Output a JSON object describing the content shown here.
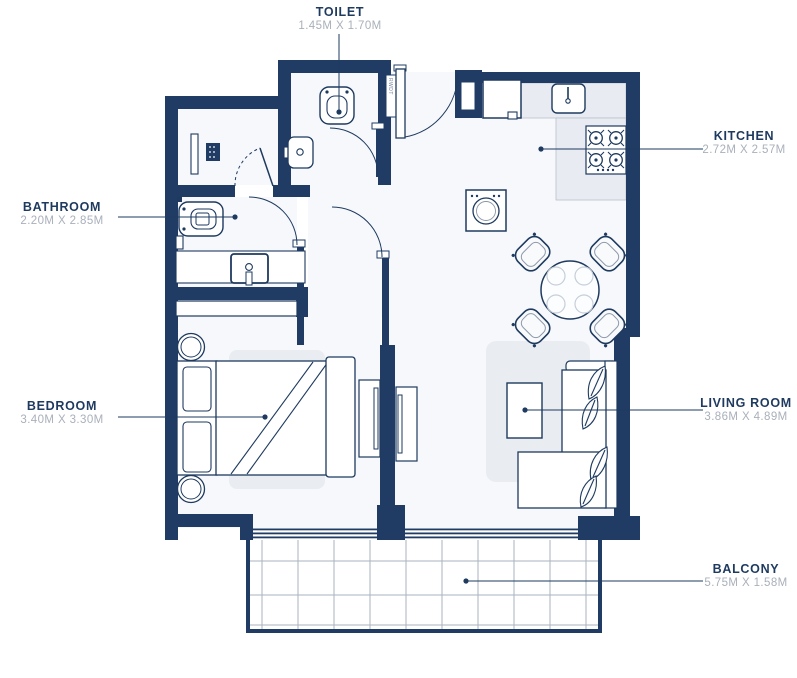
{
  "rooms": [
    {
      "id": "toilet",
      "name": "TOILET",
      "dims": "1.45M X 1.70M"
    },
    {
      "id": "kitchen",
      "name": "KITCHEN",
      "dims": "2.72M X 2.57M"
    },
    {
      "id": "bathroom",
      "name": "BATHROOM",
      "dims": "2.20M X 2.85M"
    },
    {
      "id": "bedroom",
      "name": "BEDROOM",
      "dims": "3.40M X 3.30M"
    },
    {
      "id": "living",
      "name": "LIVING ROOM",
      "dims": "3.86M X 4.89M"
    },
    {
      "id": "balcony",
      "name": "BALCONY",
      "dims": "5.75M X 1.58M"
    }
  ],
  "shaft_label": "RWDT",
  "colors": {
    "wall": "#203c64",
    "room_name": "#1e3a5f",
    "room_dims": "#a9b0ba",
    "floor": "#f6f8fb",
    "counter": "#e8ebf1",
    "balcony_grid": "#aab3c0"
  },
  "fixtures": {
    "toilet_room": [
      "toilet",
      "wash-basin"
    ],
    "utility_closet": [
      "shelf",
      "appliance-unit",
      "folding-door"
    ],
    "bathroom": [
      "toilet",
      "vanity-counter",
      "basin",
      "paper-holder"
    ],
    "kitchen": [
      "fridge",
      "sink",
      "hob-4-burner",
      "washing-machine",
      "l-counter"
    ],
    "dining": [
      "round-table",
      "chair",
      "chair",
      "chair",
      "chair"
    ],
    "living_room": [
      "rug",
      "coffee-table",
      "corner-sofa",
      "plants",
      "tv-unit"
    ],
    "bedroom": [
      "wardrobe",
      "double-bed",
      "pillows",
      "bedside-table",
      "bedside-table",
      "rug",
      "tv-unit"
    ],
    "balcony": [
      "tiled-floor",
      "sliding-windows"
    ]
  }
}
